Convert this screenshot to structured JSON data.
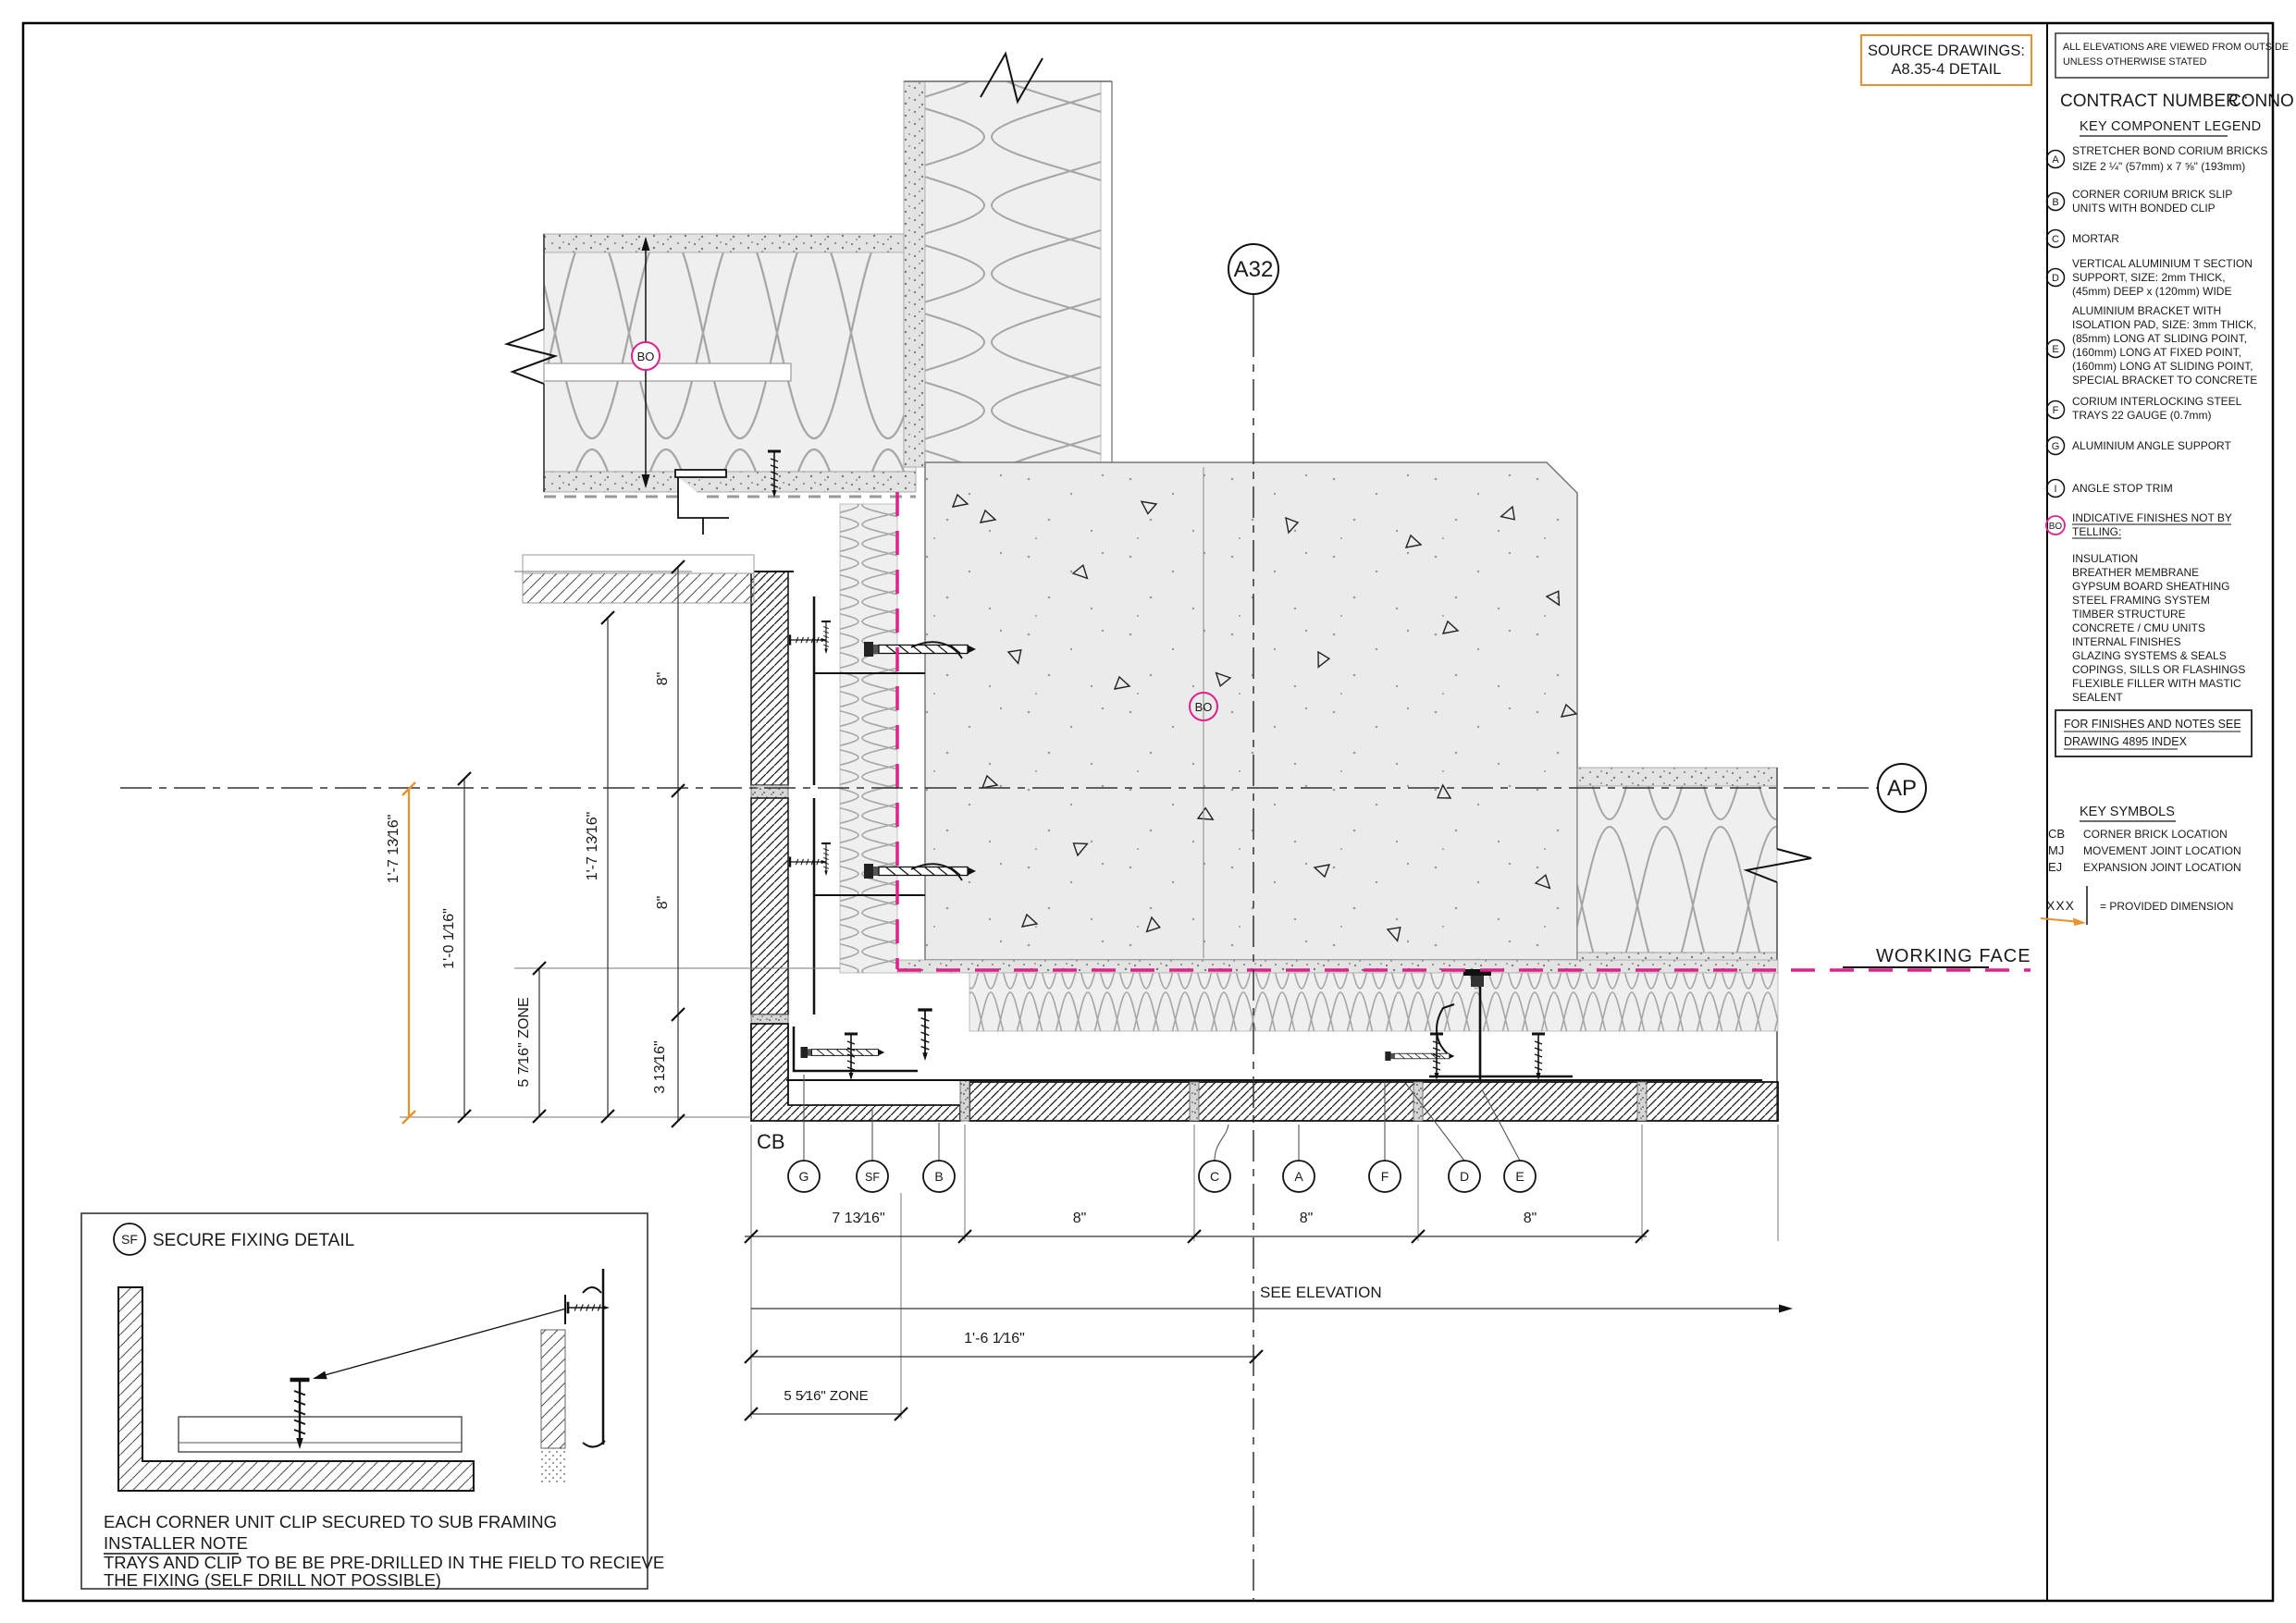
{
  "title_block": {
    "source_drawings_line1": "SOURCE DRAWINGS:",
    "source_drawings_line2": "A8.35-4 DETAIL",
    "elevation_note_line1": "ALL ELEVATIONS ARE VIEWED FROM OUTSIDE",
    "elevation_note_line2": "UNLESS OTHERWISE STATED",
    "contract_label": "CONTRACT NUMBER :",
    "contract_value": "CONNO"
  },
  "legend": {
    "title": "KEY COMPONENT LEGEND",
    "items": [
      {
        "key": "A",
        "lines": [
          "STRETCHER BOND CORIUM BRICKS",
          "SIZE 2 ¼\" (57mm) x 7 ⅝\" (193mm)"
        ]
      },
      {
        "key": "B",
        "lines": [
          "CORNER CORIUM BRICK SLIP",
          "UNITS WITH BONDED CLIP"
        ]
      },
      {
        "key": "C",
        "lines": [
          "MORTAR"
        ]
      },
      {
        "key": "D",
        "lines": [
          "VERTICAL ALUMINIUM T SECTION",
          "SUPPORT, SIZE: 2mm THICK,",
          "(45mm) DEEP x (120mm) WIDE"
        ]
      },
      {
        "key": "E",
        "lines": [
          "ALUMINIUM BRACKET WITH",
          "ISOLATION PAD, SIZE: 3mm THICK,",
          "(85mm) LONG AT SLIDING POINT,",
          "(160mm) LONG AT FIXED POINT,",
          "(160mm) LONG AT SLIDING POINT,",
          "SPECIAL BRACKET TO CONCRETE"
        ]
      },
      {
        "key": "F",
        "lines": [
          "CORIUM INTERLOCKING STEEL",
          "TRAYS 22 GAUGE (0.7mm)"
        ]
      },
      {
        "key": "G",
        "lines": [
          "ALUMINIUM ANGLE SUPPORT"
        ]
      },
      {
        "key": "I",
        "lines": [
          "ANGLE STOP TRIM"
        ]
      },
      {
        "key": "BO",
        "lines": [
          "INDICATIVE FINISHES NOT BY",
          "TELLING:"
        ]
      }
    ],
    "finishes": [
      "INSULATION",
      "BREATHER MEMBRANE",
      "GYPSUM BOARD SHEATHING",
      "STEEL FRAMING SYSTEM",
      "TIMBER STRUCTURE",
      "CONCRETE  / CMU UNITS",
      "INTERNAL FINISHES",
      "GLAZING SYSTEMS & SEALS",
      "COPINGS, SILLS OR FLASHINGS",
      "FLEXIBLE FILLER WITH MASTIC",
      "SEALENT"
    ],
    "finishes_note_line1": "FOR FINISHES AND NOTES SEE",
    "finishes_note_line2": "DRAWING 4895 INDEX"
  },
  "key_symbols": {
    "title": "KEY SYMBOLS",
    "rows": [
      {
        "key": "CB",
        "label": "CORNER BRICK LOCATION"
      },
      {
        "key": "MJ",
        "label": "MOVEMENT JOINT LOCATION"
      },
      {
        "key": "EJ",
        "label": "EXPANSION JOINT LOCATION"
      }
    ],
    "provided_symbol": "XXX",
    "provided_label": "=  PROVIDED DIMENSION"
  },
  "drawing": {
    "bubble_top": "A32",
    "bubble_right": "AP",
    "bo": "BO",
    "working_face": "WORKING FACE",
    "corner_label": "CB",
    "callouts": [
      "G",
      "SF",
      "B",
      "C",
      "A",
      "F",
      "D",
      "E"
    ],
    "dims": {
      "d_1_7_13_16": "1'-7 13⁄16\"",
      "d_1_0_1_16": "1'-0 1⁄16\"",
      "d_5_7_16_zone": "5 7⁄16\" ZONE",
      "d_8": "8\"",
      "d_3_13_16": "3 13⁄16\"",
      "d_7_13_16": "7 13⁄16\"",
      "d_1_6_1_16": "1'-6 1⁄16\"",
      "d_5_5_16_zone": "5 5⁄16\" ZONE",
      "see_elevation": "SEE ELEVATION"
    },
    "colors": {
      "magenta": "#e0218a",
      "orange": "#e8922a"
    }
  },
  "sf_detail": {
    "bubble": "SF",
    "title": "SECURE FIXING DETAIL",
    "note1": "EACH CORNER UNIT CLIP SECURED TO SUB FRAMING",
    "note2": "INSTALLER NOTE",
    "note3": "TRAYS AND CLIP TO BE BE PRE-DRILLED IN THE FIELD TO RECIEVE",
    "note4": "THE FIXING (SELF DRILL NOT POSSIBLE)"
  }
}
